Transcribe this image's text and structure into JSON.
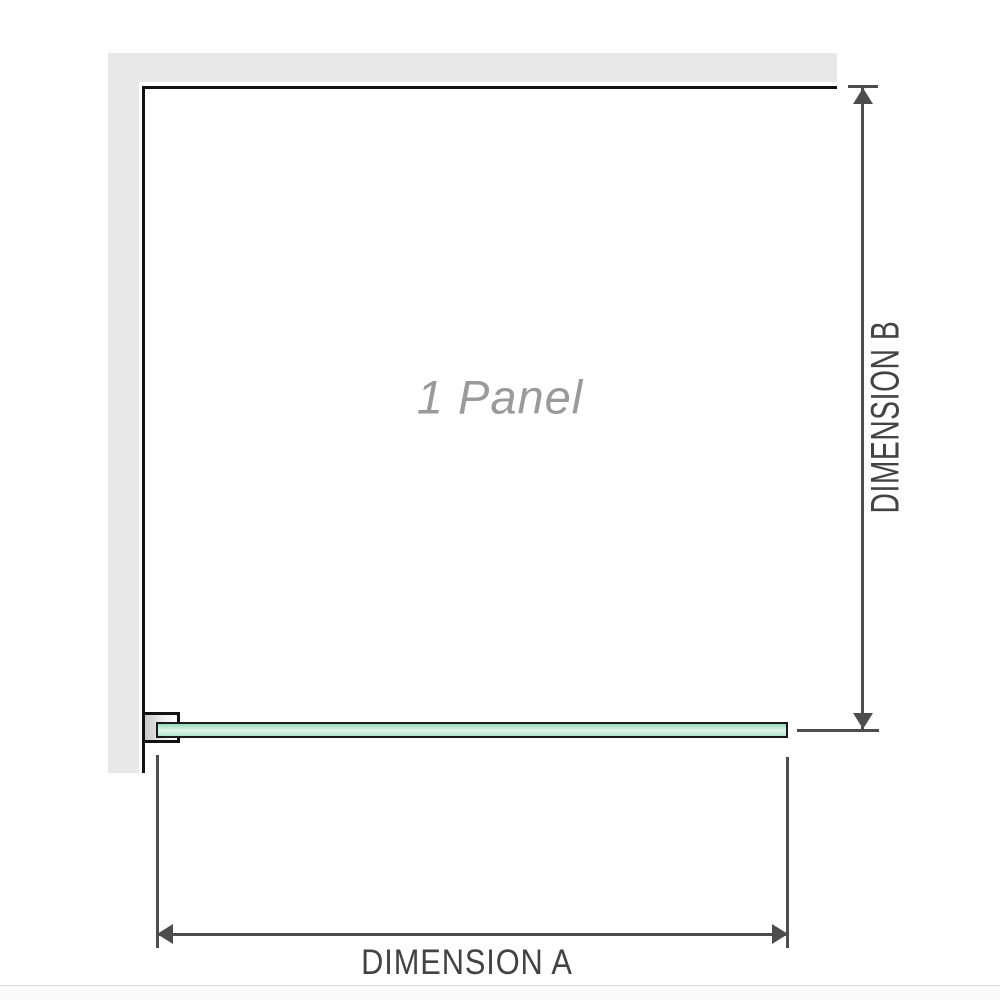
{
  "labels": {
    "panel": "1 Panel",
    "dimension_a": "DIMENSION A",
    "dimension_b": "DIMENSION B"
  },
  "icons": {
    "dimension_b_top": "arrow-up-icon",
    "dimension_b_bottom": "arrow-down-icon",
    "dimension_a_left": "arrow-left-icon",
    "dimension_a_right": "arrow-right-icon"
  },
  "colors": {
    "wall": "#e8e8e8",
    "outline": "#121212",
    "dimension_line": "#4d4d4d",
    "label_text": "#434343",
    "panel_text": "#9a9a9a",
    "glass_border": "#1a1a1a",
    "glass_top": "#96d8b6",
    "glass_mid": "#e2f5ea",
    "glass_bottom": "#b2e4cb",
    "bracket_left": "#c9c9c9",
    "bracket_right": "#ffffff",
    "page_edge": "#dcdcdc",
    "page_below": "#fafafa"
  }
}
